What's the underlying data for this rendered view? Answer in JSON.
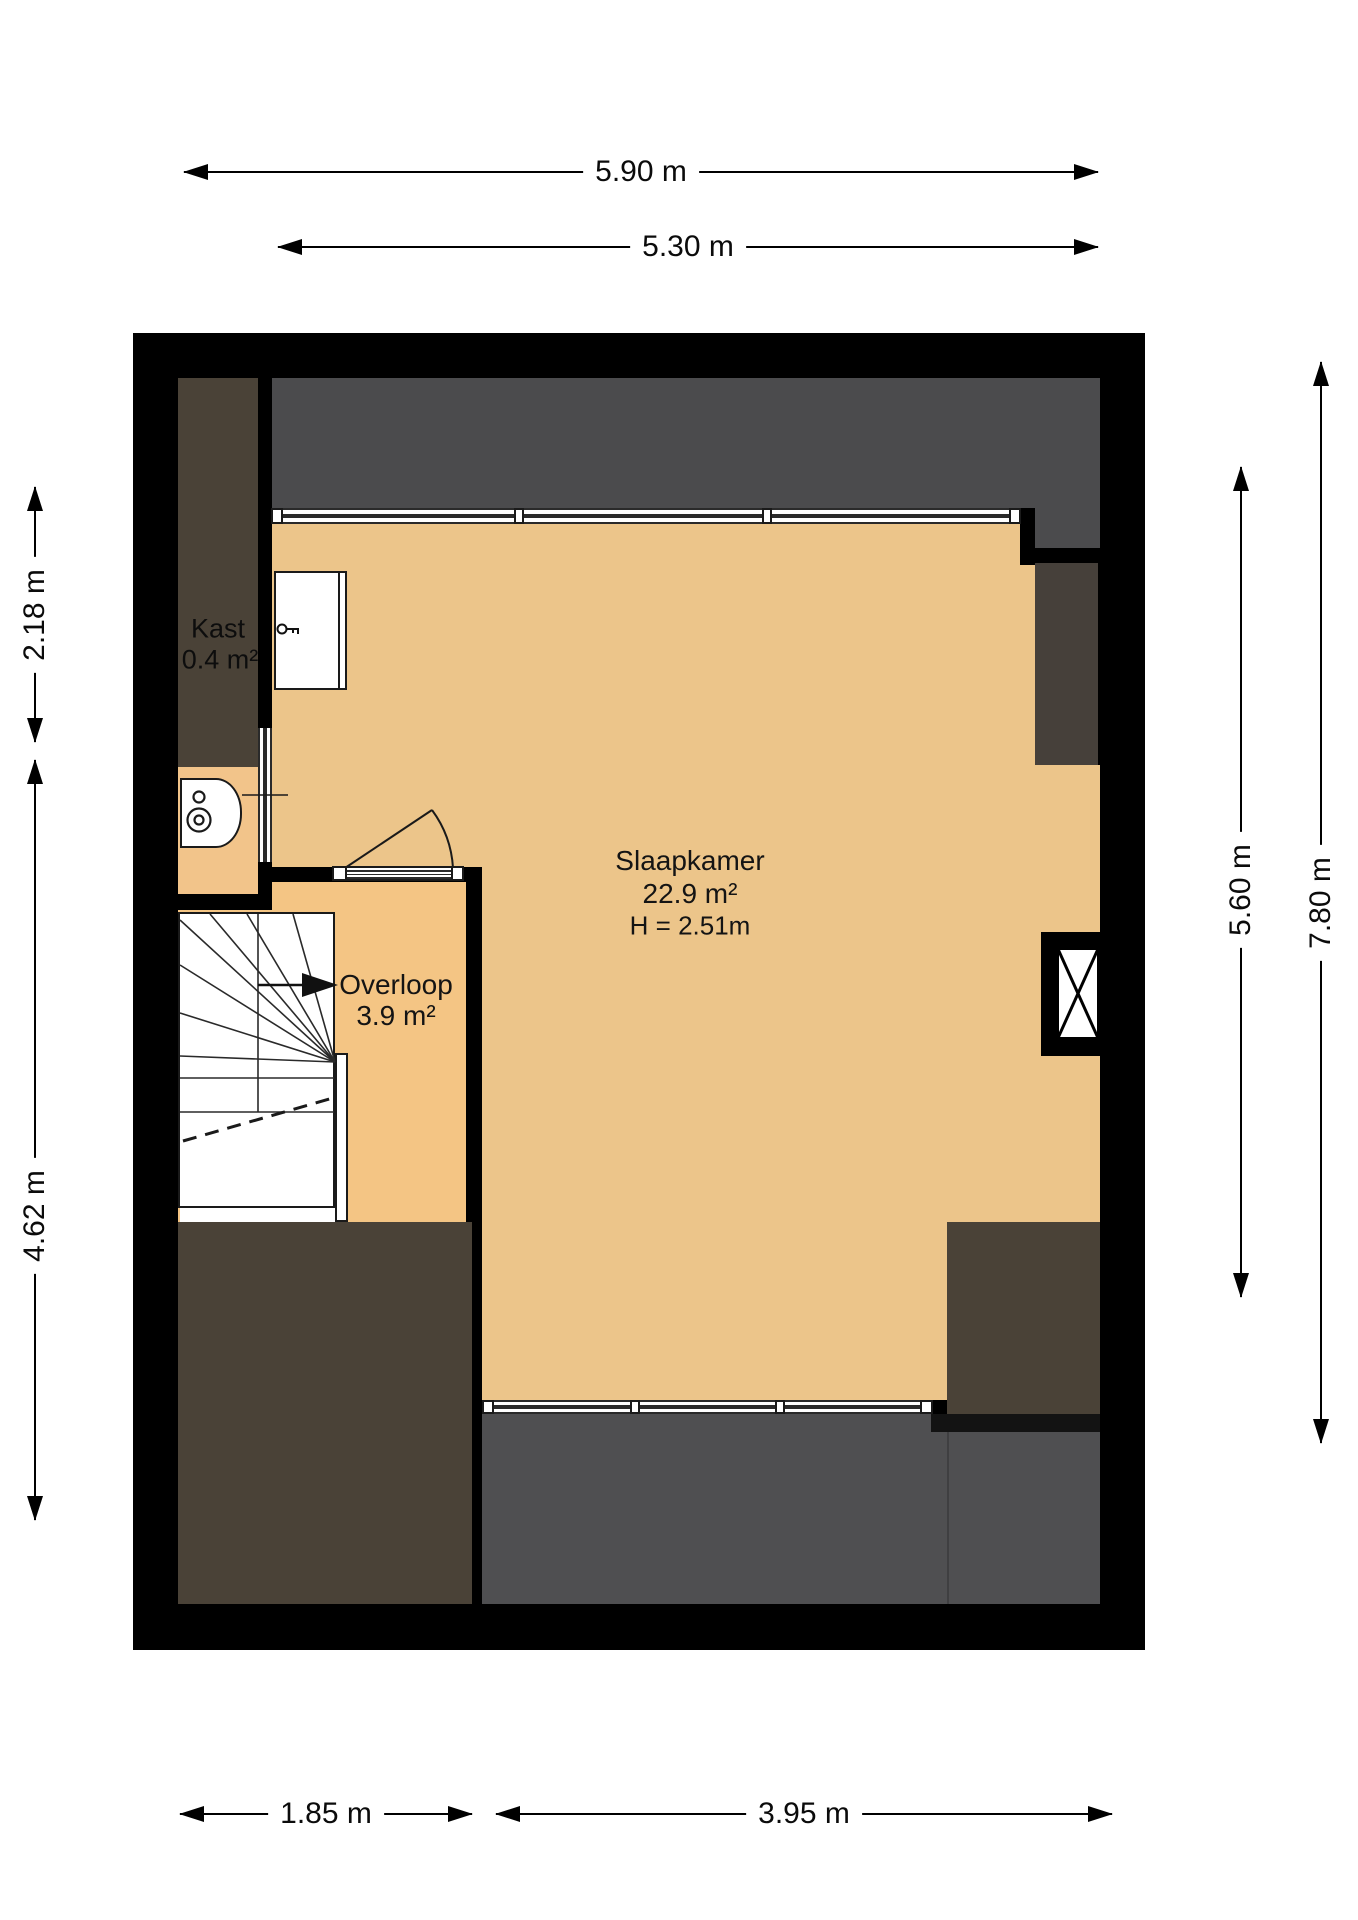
{
  "title": "Floor plan - second floor (attic)",
  "floorplan": {
    "rooms": [
      {
        "id": "slaapkamer",
        "name": "Slaapkamer",
        "area": "22.9 m²",
        "ceiling_height": "H = 2.51m"
      },
      {
        "id": "overloop",
        "name": "Overloop",
        "area": "3.9 m²"
      },
      {
        "id": "kast",
        "name": "Kast",
        "area": "0.4 m²"
      }
    ],
    "dimensions": {
      "top": [
        {
          "label": "5.90 m"
        },
        {
          "label": "5.30 m"
        }
      ],
      "left": [
        {
          "label": "2.18 m"
        },
        {
          "label": "4.62 m"
        }
      ],
      "right": [
        {
          "label": "5.60 m"
        },
        {
          "label": "7.80 m"
        }
      ],
      "bottom": [
        {
          "label": "1.85 m"
        },
        {
          "label": "3.95 m"
        }
      ]
    },
    "features": [
      "top-window",
      "bottom-window",
      "internal-window",
      "closet-door",
      "key-icon",
      "boiler-unit",
      "winder-staircase",
      "stair-direction-arrow",
      "door-swing",
      "shaft-chimney"
    ],
    "colors": {
      "wall": "#000000",
      "bedroom_floor": "#ECC58A",
      "overloop_floor": "#F4C584",
      "corridor_floor": "#F2C48A",
      "roof_gray": "#4B4B4D",
      "roof_gray_bottom": "#4F4F51",
      "roof_brown": "#4A4237",
      "roof_brown_dark": "#46403A",
      "window_frame": "#2A2A2A",
      "background": "#FFFFFF"
    }
  }
}
